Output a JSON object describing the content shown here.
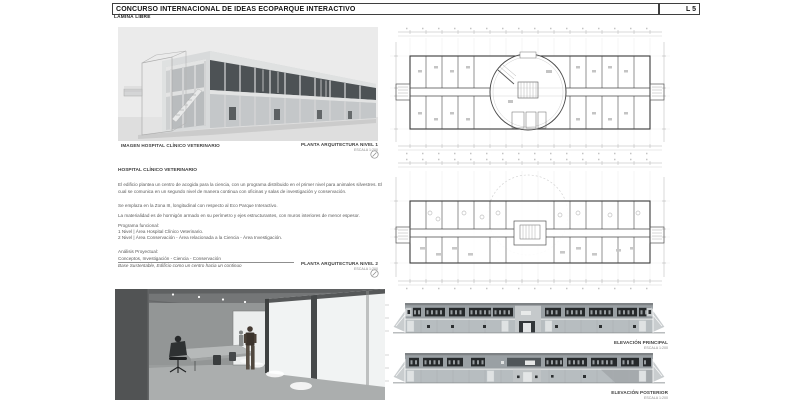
{
  "sheet": {
    "title": "CONCURSO INTERNACIONAL DE IDEAS ECOPARQUE INTERACTIVO",
    "subtitle": "LÁMINA LIBRE",
    "number": "L 5"
  },
  "hero": {
    "caption": "IMAGEN HOSPITAL CLÍNICO VETERINARIO"
  },
  "plans": {
    "level1": {
      "title": "PLANTA ARQUITECTURA NIVEL 1",
      "scale": "ESCALA 1:200"
    },
    "level2": {
      "title": "PLANTA ARQUITECTURA NIVEL 2",
      "scale": "ESCALA 1:200"
    }
  },
  "elevations": {
    "front": {
      "title": "ELEVACIÓN PRINCIPAL",
      "scale": "ESCALA 1:200"
    },
    "back": {
      "title": "ELEVACIÓN POSTERIOR",
      "scale": "ESCALA 1:200"
    }
  },
  "description": {
    "heading": "HOSPITAL CLÍNICO VETERINARIO",
    "paragraph1": "El edificio plantea un centro de acogida para la ciencia, con un programa distribuido en el primer nivel para animales silvestres. El cual se comunica en un segundo nivel de manera continua con oficinas y salas de investigación y conservación.",
    "paragraph2": "Se emplaza en la Zona III, longitudinal con respecto al Eco Parque Interactivo.",
    "paragraph3": "La materialidad es de hormigón armado en su perímetro y ejes estructurantes, con muros interiores de menor espesor.",
    "program_heading": "Programa funcional:",
    "program_item1": "1 Nivel | Área Hospital Clínico Veterinario.",
    "program_item2": "2 Nivel | Área Conservación - Área relacionada a la Ciencia - Área Investigación.",
    "analysis_heading": "Análisis Proyectual:",
    "analysis_concepts": "Conceptos, Investigación - Ciencia - Conservación",
    "analysis_base": "Base Sustentable, Edificio como un centro hacia un continuo"
  },
  "colors": {
    "window_dark": "#26292b",
    "panel_gray": "#9aa0a4",
    "panel_light": "#b7bdc0",
    "render_bg": "#ebebeb"
  }
}
